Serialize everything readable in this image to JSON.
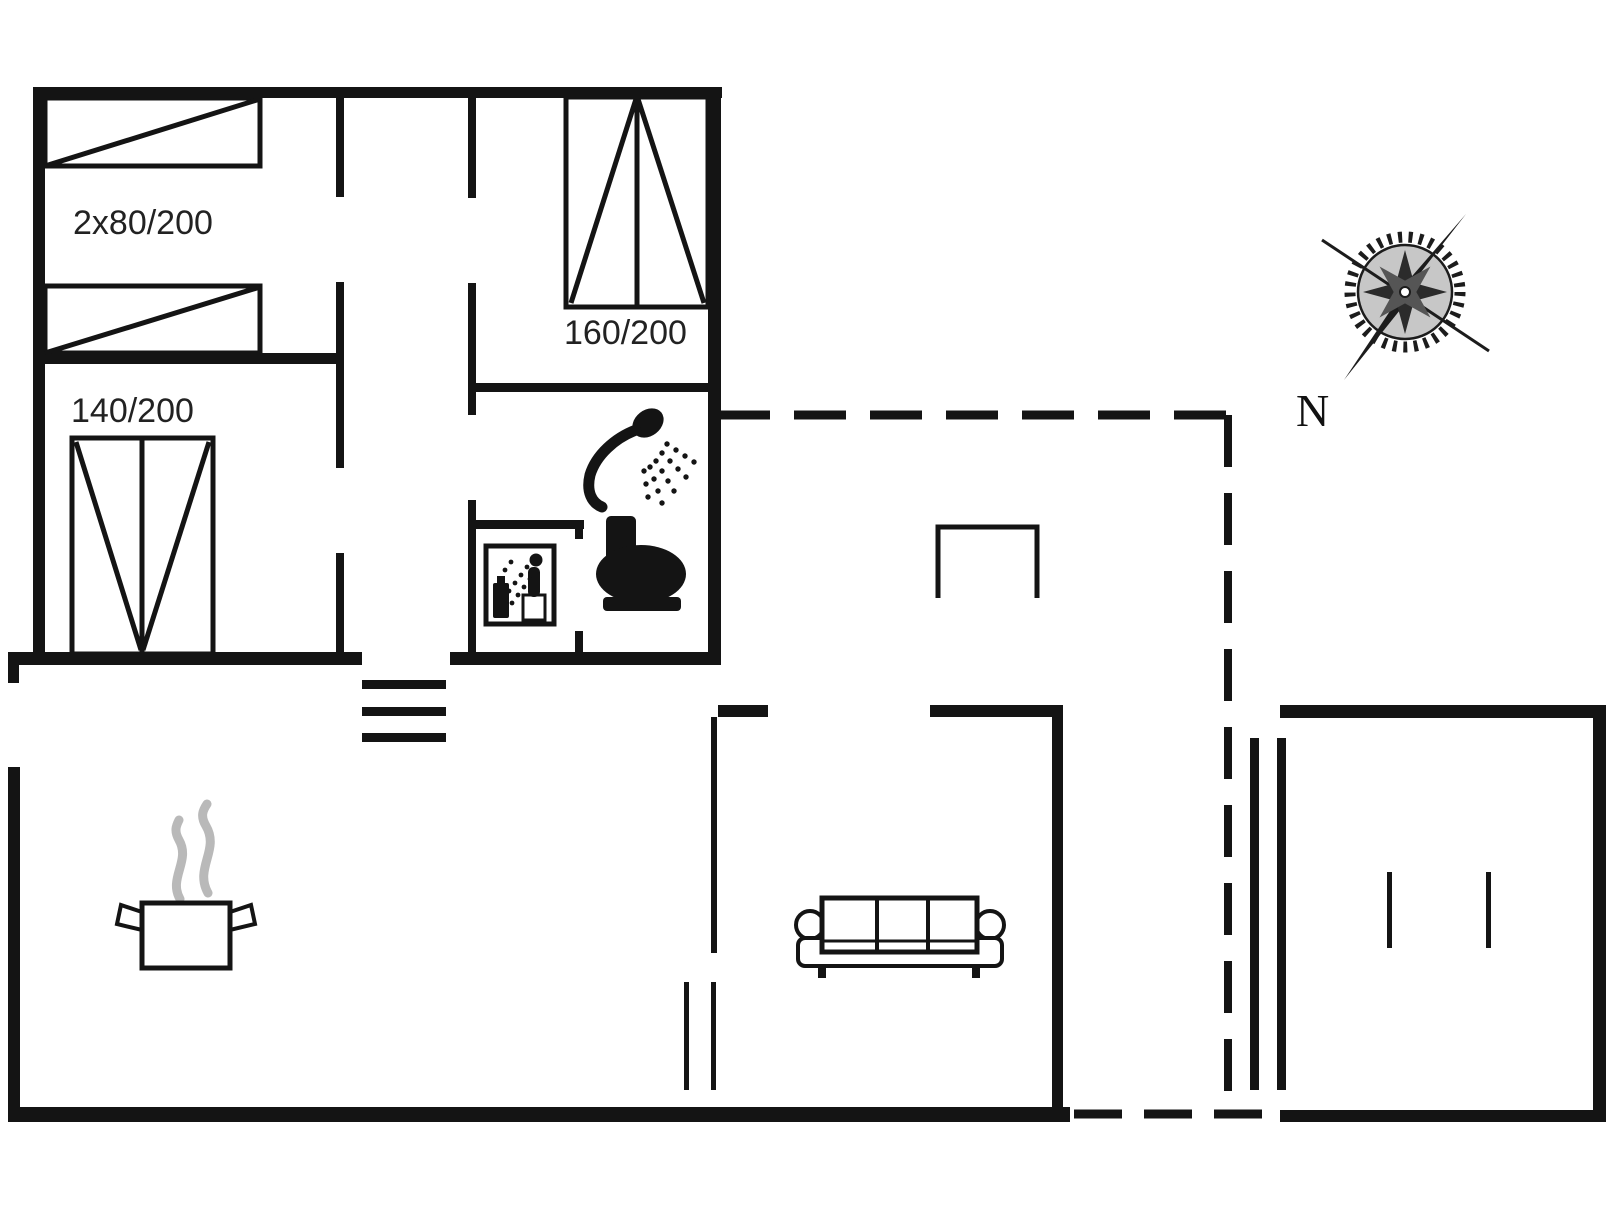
{
  "floor_plan": {
    "type": "holiday-house-floor-plan",
    "labels": {
      "bunk_beds": "2x80/200",
      "double_bed": "140/200",
      "large_bed": "160/200",
      "north": "N"
    },
    "icons": {
      "compass": "compass-rose-icon",
      "shower": "shower-icon",
      "toilet": "toilet-icon",
      "cleaning_room": "cleaning-room-icon",
      "steps": "steps-icon",
      "pot": "cooking-pot-icon",
      "steam": "steam-icon",
      "sofa": "sofa-icon",
      "beds": "bed-icon",
      "terrace_mark": "terrace-opening-icon"
    },
    "colors": {
      "walls": "#141414",
      "background": "#ffffff",
      "steam": "#b9b9b9",
      "compass": "#1c1c1c"
    }
  }
}
